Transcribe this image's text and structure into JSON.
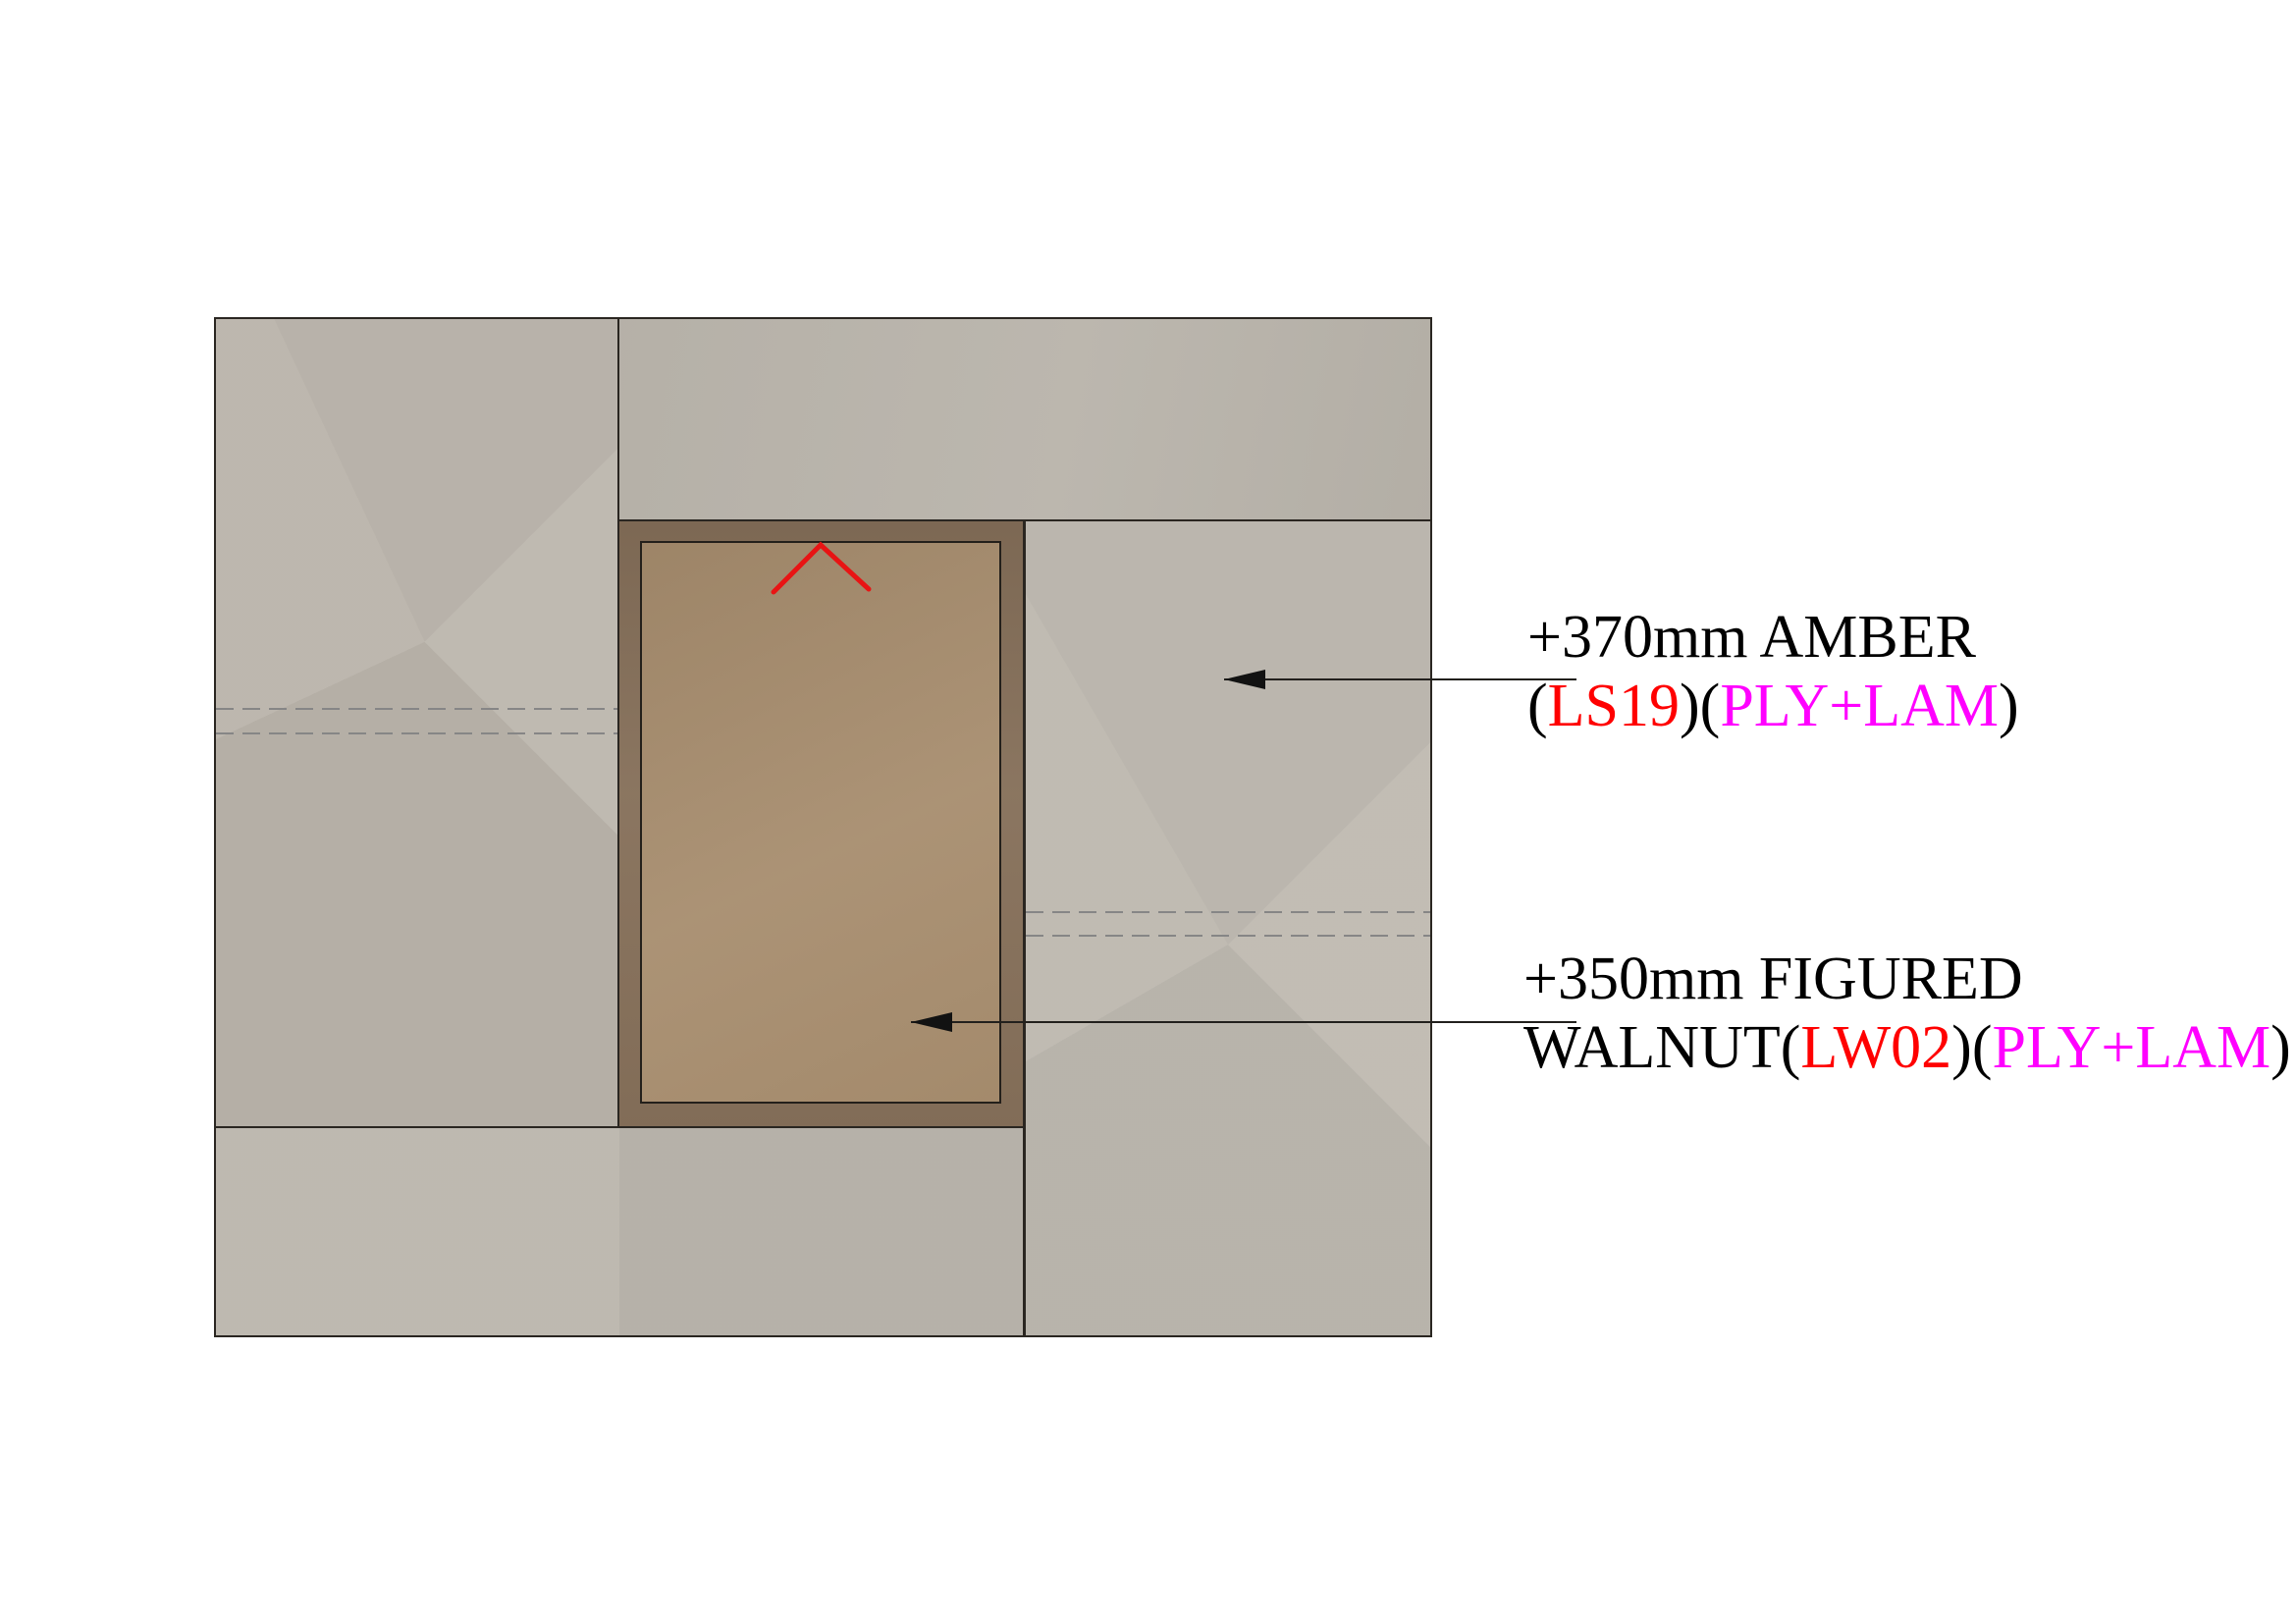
{
  "drawing_type": "joinery elevation detail",
  "colors": {
    "code_red": "#ff0000",
    "material_magenta": "#ff00ff",
    "text_black": "#000000",
    "panel_laminate_beige": "#bcb6ad",
    "frame_walnut_dark": "#86705a",
    "panel_walnut_face": "#a78d6e",
    "chevron_red": "#e81414",
    "outline_dark": "#2a2621",
    "dashed_gray": "#868686"
  },
  "annotations": [
    {
      "line1": "+370mm AMBER",
      "line2_prefix": "(",
      "code": "LS19",
      "line2_mid": ")(",
      "material": "PLY+LAM",
      "line2_suffix": ")"
    },
    {
      "line1": "+350mm FIGURED",
      "line2_prefix": "WALNUT(",
      "code": "LW02",
      "line2_mid": ")(",
      "material": "PLY+LAM",
      "line2_suffix": ")"
    }
  ]
}
